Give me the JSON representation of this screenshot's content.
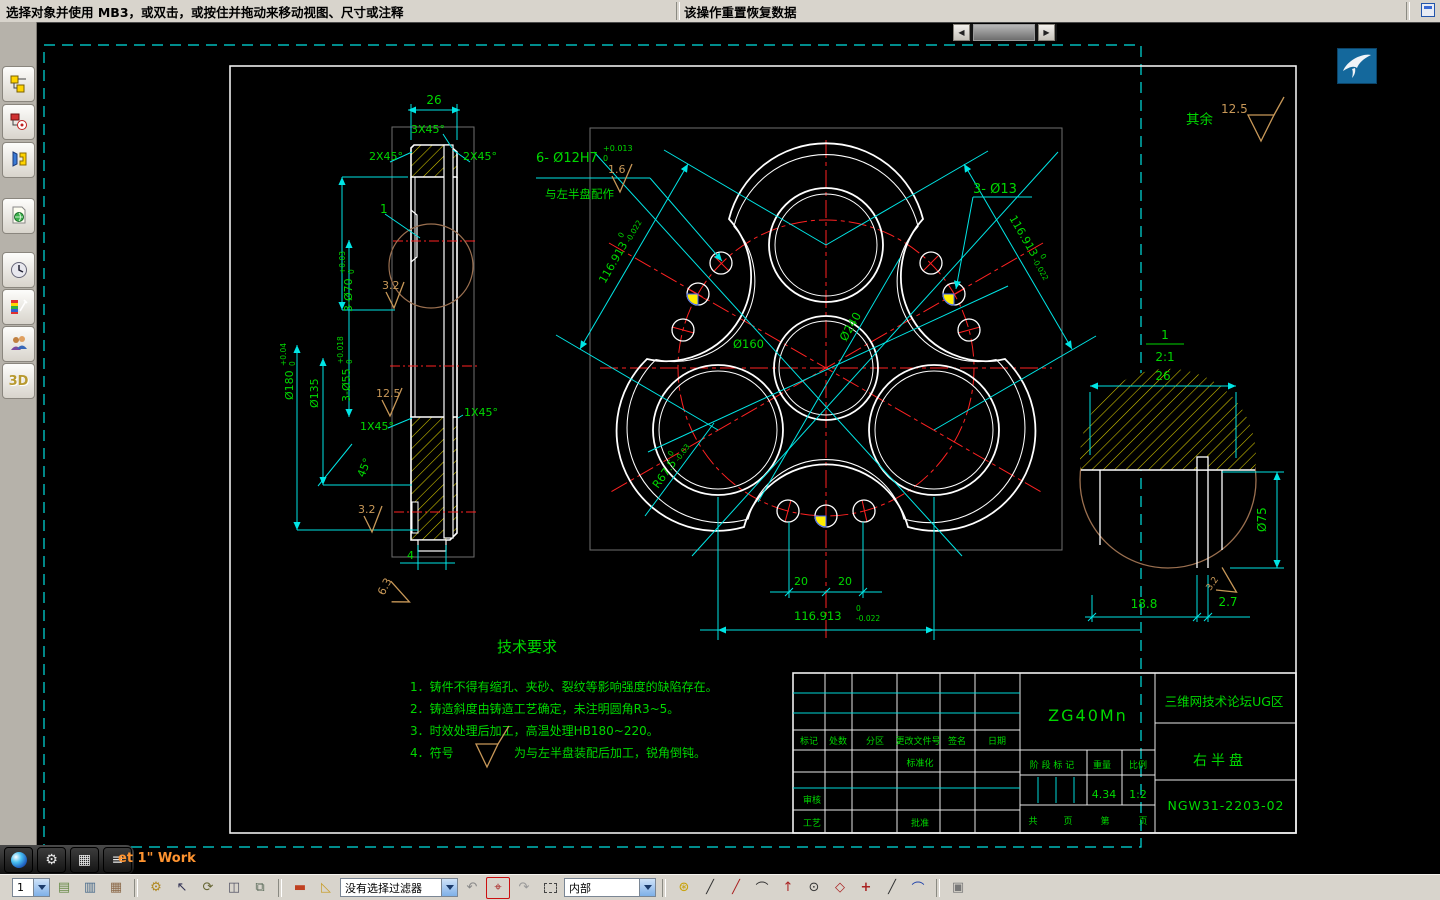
{
  "status_bar": {
    "message": "选择对象并使用 MB3，或双击，或按住并拖动来移动视图、尺寸或注释",
    "action_hint": "该操作重置恢复数据"
  },
  "left_toolbar": {
    "items": [
      "assembly-navigator",
      "constraint-navigator",
      "part-navigator",
      "reuse-library",
      "history",
      "visualization",
      "roles",
      "3d-input"
    ]
  },
  "sheet_tab": {
    "label": "et 1\" Work"
  },
  "icons": {
    "scroll_left": "◀",
    "scroll_right": "▶",
    "gear": "⚙",
    "grid": "▦",
    "list": "≡",
    "layer_a": "▤",
    "layer_b": "▥",
    "layer_c": "▦",
    "key": "⚙",
    "select": "↖",
    "rotate": "⟳",
    "pan": "◫",
    "zoomwin": "⧉",
    "ruler": "▬",
    "slope": "◺",
    "undo": "↶",
    "snappoint": "⌖",
    "redo": "↷",
    "snap1": "⊛",
    "snap2": "╱",
    "snap3": "╱",
    "snap4": "⌒",
    "snap5": "↑",
    "snap6": "⊙",
    "snap7": "◇",
    "snap8": "+",
    "snap9": "╱",
    "snap10": "⌒",
    "cube": "▣",
    "d3": "3D"
  },
  "bottom_toolbar": {
    "layer_value": "1",
    "filter_value": "没有选择过滤器",
    "scope_value": "内部"
  },
  "drawing": {
    "general_note": {
      "prefix": "其余",
      "roughness": "12.5"
    },
    "side_view": {
      "width": "26",
      "chamfer_top": "3X45°",
      "chamfer_left": "2X45°",
      "chamfer_right": "2X45°",
      "bore70": "3-Ø70",
      "bore70_tu": "+0.03",
      "bore70_td": "0",
      "od180": "Ø180",
      "od180_tu": "+0.04",
      "od180_td": "0",
      "d135": "Ø135",
      "bore55": "3-Ø55",
      "bore55_tu": "+0.018",
      "bore55_td": "0",
      "fin_a": "3.2",
      "fin_b": "12.5",
      "fin_c": "3.2",
      "fin_d": "6.3",
      "ch1l": "1X45°",
      "ch1r": "1X45°",
      "angle": "45°",
      "groove": "4",
      "detail_ref": "1"
    },
    "front_view": {
      "holes12": "6- Ø12H7",
      "holes12_tu": "+0.013",
      "holes12_td": "0",
      "holes12_note": "与左半盘配作",
      "fin_16": "1.6",
      "holes13": "3- Ø13",
      "dist": "116.913",
      "dist_tu": "0",
      "dist_td": "-0.022",
      "d160": "Ø160",
      "d240": "Ø240",
      "r675": "R67.5",
      "r675_tu": "0",
      "r675_td": "-0.03",
      "off_l": "20",
      "off_r": "20"
    },
    "detail_view": {
      "label": "1",
      "scale": "2:1",
      "width": "26",
      "d75": "Ø75",
      "len": "18.8",
      "rib": "2.7",
      "fin": "3.2"
    },
    "tech_req": {
      "title": "技术要求",
      "item1": "1．铸件不得有缩孔、夹砂、裂纹等影响强度的缺陷存在。",
      "item2": "2．铸造斜度由铸造工艺确定，未注明圆角R3~5。",
      "item3": "3．时效处理后加工，高温处理HB180~220。",
      "item4_prefix": "4．符号",
      "item4_suffix": "为与左半盘装配后加工，锐角倒钝。"
    },
    "title_block": {
      "material": "ZG40Mn",
      "company": "三维网技术论坛UG区",
      "part_name": "右半盘",
      "drawing_no": "NGW31-2203-02",
      "h_mark": "标记",
      "h_count": "处数",
      "h_zone": "分区",
      "h_file": "更改文件号",
      "h_sign": "签名",
      "h_date": "日期",
      "standardization": "标准化",
      "checker": "审核",
      "process": "工艺",
      "approver": "批准",
      "stage_label": "阶 段 标 记",
      "weight_label": "重量",
      "scale_label": "比例",
      "weight": "4.34",
      "scale": "1:2",
      "sheet_a": "共",
      "sheet_b": "页",
      "sheet_c": "第",
      "sheet_d": "页"
    }
  }
}
